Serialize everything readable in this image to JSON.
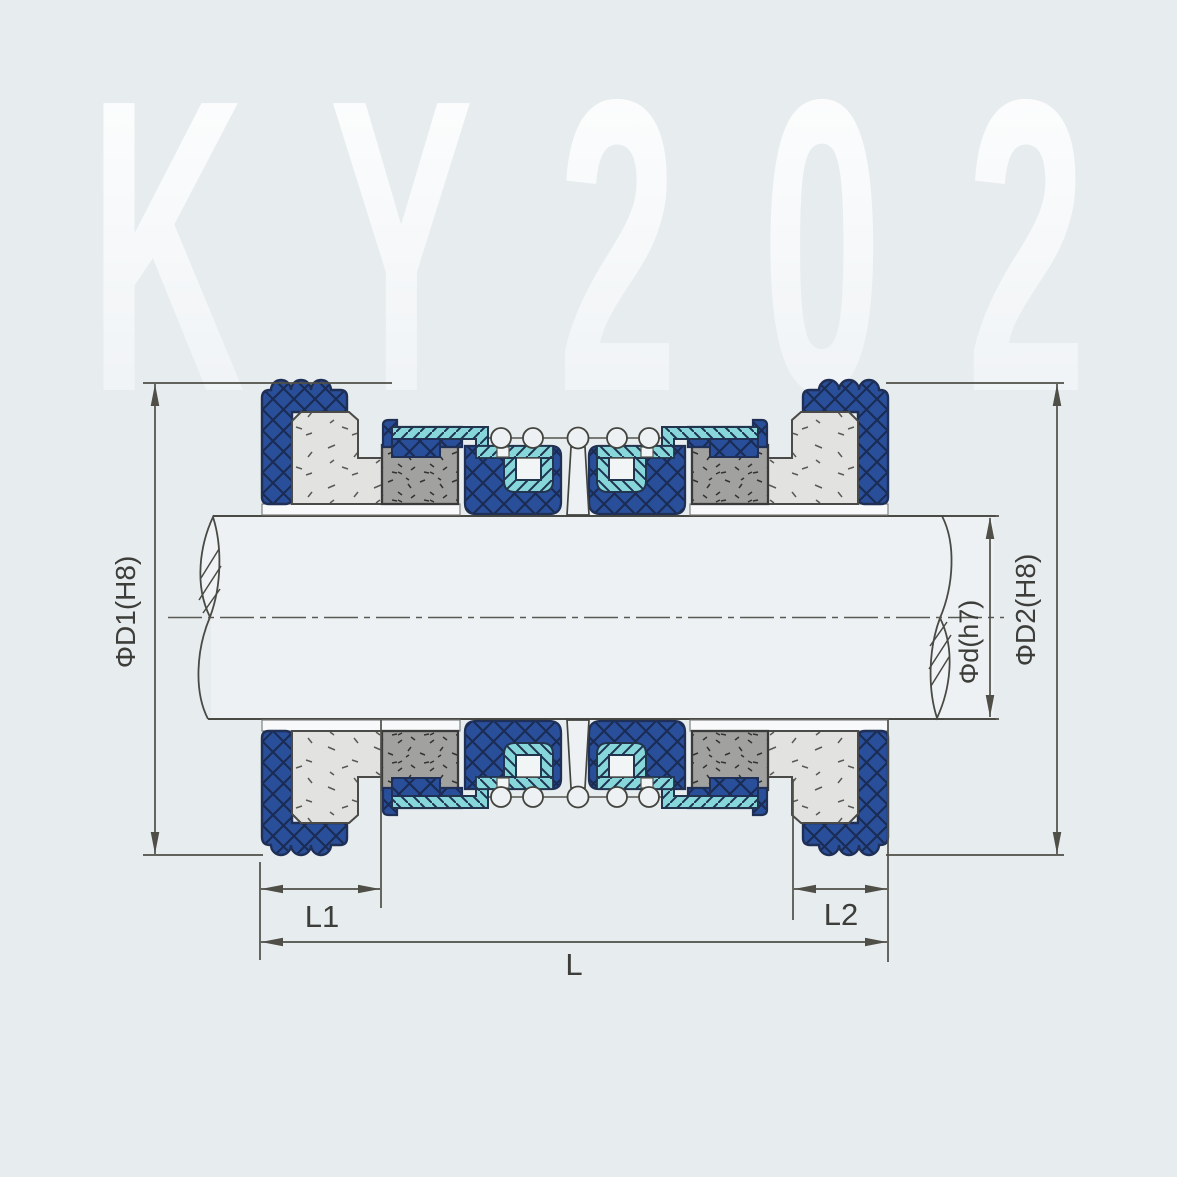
{
  "watermark": "KY202",
  "dims": {
    "d1": "ΦD1(H8)",
    "d": "Φd(h7)",
    "d2": "ΦD2(H8)",
    "l1": "L1",
    "l2": "L2",
    "l": "L"
  },
  "colors": {
    "background": "#e7ecef",
    "bellows_blue": "#2a4f9a",
    "bellows_hatch": "#1a2c55",
    "retainer_teal": "#87d7da",
    "seal_face_gray": "#a1a19f",
    "seat_light": "#e2e3e1",
    "shaft_fill": "#edf1f3",
    "outline": "#333333",
    "dimension_line": "#4f4f48",
    "watermark_top": "#ffffff",
    "watermark_bottom": "#edf1f4"
  }
}
